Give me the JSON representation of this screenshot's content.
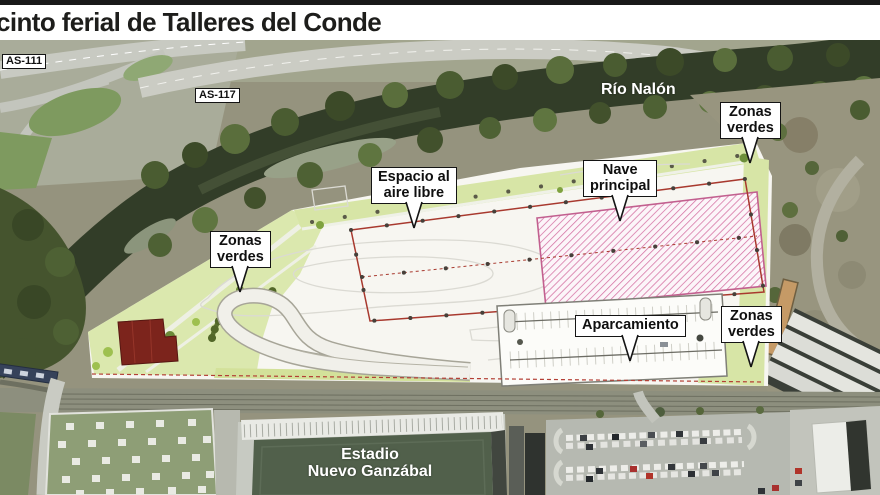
{
  "header": {
    "title": "cinto ferial de Talleres del Conde"
  },
  "map": {
    "road_signs": [
      {
        "label": "AS-111"
      },
      {
        "label": "AS-117"
      }
    ],
    "river": {
      "label": "Río Nalón"
    },
    "callouts": [
      {
        "id": "zonas-verdes-north",
        "lines": [
          "Zonas",
          "verdes"
        ]
      },
      {
        "id": "espacio-aire-libre",
        "lines": [
          "Espacio al",
          "aire libre"
        ]
      },
      {
        "id": "nave-principal",
        "lines": [
          "Nave",
          "principal"
        ]
      },
      {
        "id": "zonas-verdes-west",
        "lines": [
          "Zonas",
          "verdes"
        ]
      },
      {
        "id": "aparcamiento",
        "lines": [
          "Aparcamiento"
        ]
      },
      {
        "id": "zonas-verdes-east",
        "lines": [
          "Zonas",
          "verdes"
        ]
      }
    ],
    "stadium": {
      "lines": [
        "Estadio",
        "Nuevo Ganzábal"
      ]
    }
  },
  "colors": {
    "header_bar": "#191919",
    "title_text": "#1d1d1b",
    "river_water": "#323d28",
    "plan_green": "#dbe8ae",
    "plan_white": "#f7f6f1",
    "open_space_outline_red": "#a8392e",
    "nave_hatch_pink": "#d470a2",
    "callout_border": "#141414",
    "stadium_field": "#51604b"
  }
}
